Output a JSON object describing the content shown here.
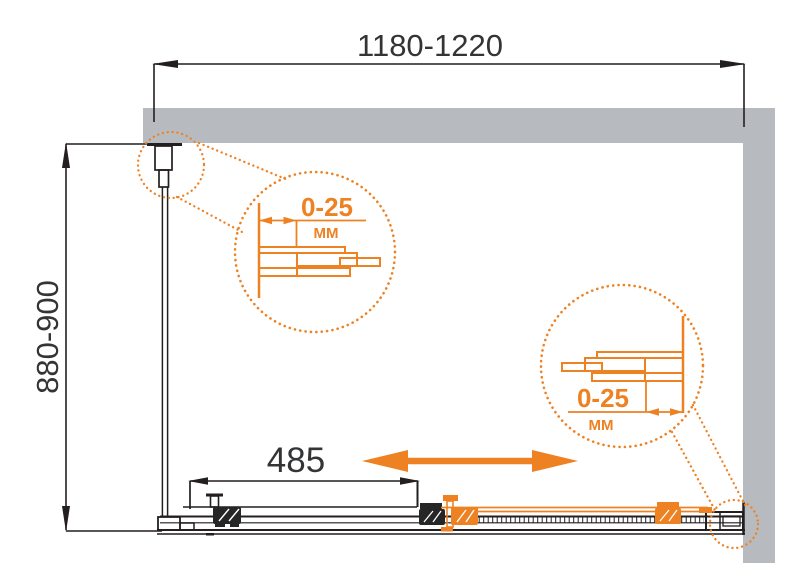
{
  "dimensions": {
    "width_range": "1180-1220",
    "depth_range": "880-900",
    "panel_width": "485"
  },
  "callouts": [
    {
      "range": "0-25",
      "unit": "MM"
    },
    {
      "range": "0-25",
      "unit": "MM"
    }
  ],
  "colors": {
    "accent_orange": "#EE8122",
    "wall_gray": "#B7BABE",
    "line_black": "#231F20",
    "text_dark": "#333436"
  }
}
